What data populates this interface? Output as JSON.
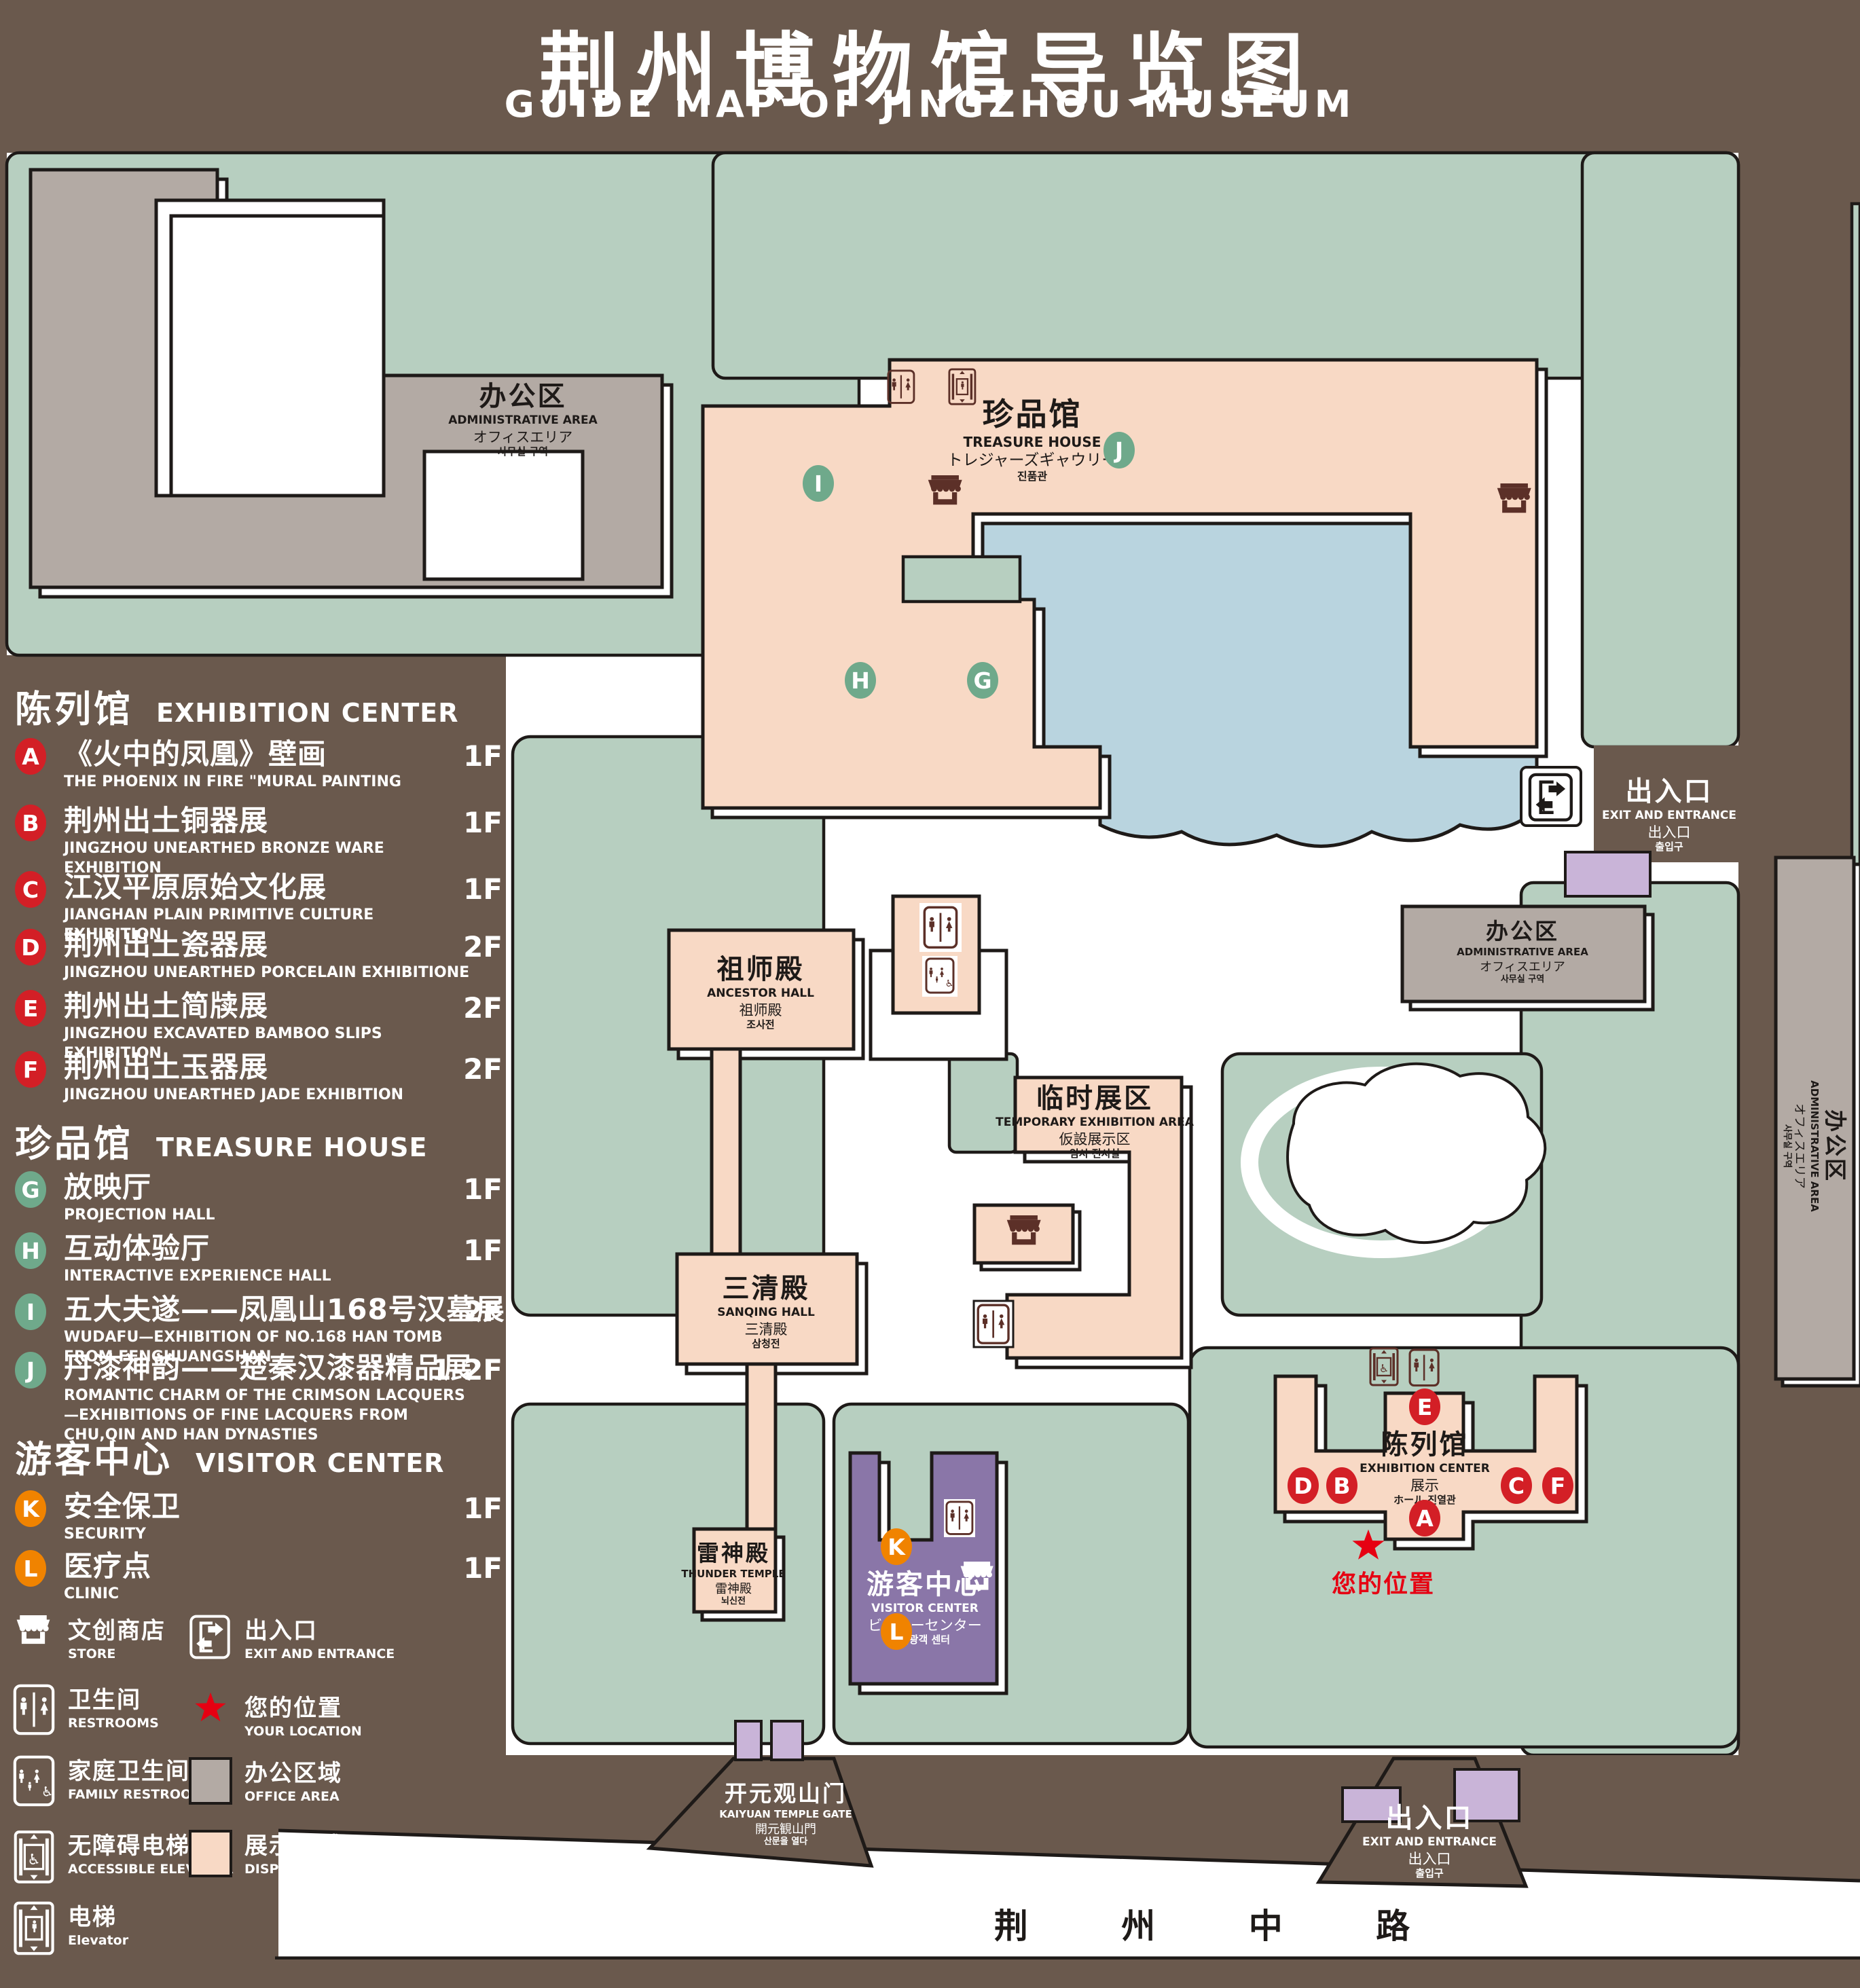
{
  "title": {
    "cn": "荆州博物馆导览图",
    "en": "GUIDE MAP OF JINGZHOU MUSEUM"
  },
  "colors": {
    "background": "#6a594d",
    "lawn": "#b7cfc0",
    "display_area": "#f8d9c5",
    "office_area": "#b3aaa4",
    "water": "#b9d4df",
    "visitor_center": "#8a76a8",
    "annex": "#c9b4d8",
    "badge_red": "#d31f26",
    "badge_green": "#6fa98b",
    "badge_orange": "#f08300",
    "location_red": "#e60012",
    "icon_maroon": "#5c3028",
    "outline": "#1e1a18"
  },
  "legend": {
    "sections": [
      {
        "cn": "陈列馆",
        "en": "EXHIBITION CENTER",
        "badge_color": "red",
        "items": [
          {
            "letter": "A",
            "cn": "《火中的凤凰》壁画",
            "en": "THE PHOENIX IN FIRE \"MURAL PAINTING",
            "floor": "1F"
          },
          {
            "letter": "B",
            "cn": "荆州出土铜器展",
            "en": "JINGZHOU UNEARTHED BRONZE WARE EXHIBITION",
            "floor": "1F"
          },
          {
            "letter": "C",
            "cn": "江汉平原原始文化展",
            "en": "JIANGHAN PLAIN PRIMITIVE CULTURE EXHIBITION",
            "floor": "1F"
          },
          {
            "letter": "D",
            "cn": "荆州出土瓷器展",
            "en": "JINGZHOU UNEARTHED PORCELAIN EXHIBITIONE",
            "floor": "2F"
          },
          {
            "letter": "E",
            "cn": "荆州出土简牍展",
            "en": "JINGZHOU EXCAVATED BAMBOO SLIPS EXHIBITION",
            "floor": "2F"
          },
          {
            "letter": "F",
            "cn": "荆州出土玉器展",
            "en": "JINGZHOU UNEARTHED JADE EXHIBITION",
            "floor": "2F"
          }
        ]
      },
      {
        "cn": "珍品馆",
        "en": "TREASURE HOUSE",
        "badge_color": "green",
        "items": [
          {
            "letter": "G",
            "cn": "放映厅",
            "en": "PROJECTION HALL",
            "floor": "1F"
          },
          {
            "letter": "H",
            "cn": "互动体验厅",
            "en": "INTERACTIVE EXPERIENCE HALL",
            "floor": "1F"
          },
          {
            "letter": "I",
            "cn": "五大夫遂——凤凰山168号汉墓展",
            "en": "WUDAFU—EXHIBITION OF NO.168 HAN TOMB FROM FENGHUANGSHAN",
            "floor": "2F"
          },
          {
            "letter": "J",
            "cn": "丹漆神韵——楚秦汉漆器精品展",
            "en": "ROMANTIC CHARM OF THE CRIMSON LACQUERS—EXHIBITIONS OF FINE LACQUERS FROM CHU,QIN AND HAN DYNASTIES",
            "floor": "1-2F"
          }
        ]
      },
      {
        "cn": "游客中心",
        "en": "VISITOR CENTER",
        "badge_color": "orange",
        "items": [
          {
            "letter": "K",
            "cn": "安全保卫",
            "en": "SECURITY",
            "floor": "1F"
          },
          {
            "letter": "L",
            "cn": "医疗点",
            "en": "CLINIC",
            "floor": "1F"
          }
        ]
      }
    ],
    "symbols": [
      {
        "icon": "store-icon",
        "cn": "文创商店",
        "en": "STORE"
      },
      {
        "icon": "exit-icon",
        "cn": "出入口",
        "en": "EXIT AND ENTRANCE"
      },
      {
        "icon": "restroom-icon",
        "cn": "卫生间",
        "en": "RESTROOMS"
      },
      {
        "icon": "location-star-icon",
        "cn": "您的位置",
        "en": "YOUR LOCATION"
      },
      {
        "icon": "family-restroom-icon",
        "cn": "家庭卫生间",
        "en": "FAMILY RESTROOMS"
      },
      {
        "icon": "office-area-swatch",
        "cn": "办公区域",
        "en": "OFFICE AREA"
      },
      {
        "icon": "accessible-elevator-icon",
        "cn": "无障碍电梯",
        "en": "ACCESSIBLE ELEVATOR"
      },
      {
        "icon": "display-area-swatch",
        "cn": "展示区域",
        "en": "DISPLAY AREA"
      },
      {
        "icon": "elevator-icon",
        "cn": "电梯",
        "en": "Elevator"
      }
    ]
  },
  "map": {
    "labels": [
      {
        "id": "admin-area-topleft",
        "lines": [
          "办公区",
          "ADMINISTRATIVE AREA",
          "オフィスエリア",
          "사무실 구역"
        ]
      },
      {
        "id": "treasure-house",
        "lines": [
          "珍品馆",
          "TREASURE HOUSE",
          "トレジャーズギャウリー",
          "진품관"
        ]
      },
      {
        "id": "ancestor-hall",
        "lines": [
          "祖师殿",
          "ANCESTOR HALL",
          "祖师殿",
          "조사전"
        ]
      },
      {
        "id": "temporary-exhibition",
        "lines": [
          "临时展区",
          "TEMPORARY EXHIBITION AREA",
          "仮設展示区",
          "임시 전시실"
        ]
      },
      {
        "id": "sanqing-hall",
        "lines": [
          "三清殿",
          "SANQING HALL",
          "三清殿",
          "삼청전"
        ]
      },
      {
        "id": "thunder-temple",
        "lines": [
          "雷神殿",
          "THUNDER TEMPLE",
          "雷神殿",
          "뇌신전"
        ]
      },
      {
        "id": "visitor-center",
        "lines": [
          "游客中心",
          "VISITOR CENTER",
          "ビジターセンター",
          "관광객 센터"
        ]
      },
      {
        "id": "exhibition-center",
        "lines": [
          "陈列馆",
          "EXHIBITION CENTER",
          "展示",
          "ホール 진열관"
        ]
      },
      {
        "id": "admin-area-right",
        "lines": [
          "办公区",
          "ADMINISTRATIVE AREA",
          "オフィスエリア",
          "사무실 구역"
        ]
      },
      {
        "id": "admin-area-strip",
        "lines": [
          "办公区",
          "ADMINISTRATIVE AREA",
          "オフィスエリア",
          "사무실 구역"
        ]
      },
      {
        "id": "exit-top-right",
        "lines": [
          "出入口",
          "EXIT AND ENTRANCE",
          "出入口",
          "출입구"
        ]
      },
      {
        "id": "exit-bottom-right",
        "lines": [
          "出入口",
          "EXIT AND ENTRANCE",
          "出入口",
          "출입구"
        ]
      },
      {
        "id": "kaiyuan-gate",
        "lines": [
          "开元观山门",
          "KAIYUAN TEMPLE GATE",
          "開元観山門",
          "산문을 열다"
        ]
      }
    ],
    "badges": [
      {
        "letter": "I",
        "color": "green"
      },
      {
        "letter": "J",
        "color": "green"
      },
      {
        "letter": "H",
        "color": "green"
      },
      {
        "letter": "G",
        "color": "green"
      },
      {
        "letter": "E",
        "color": "red"
      },
      {
        "letter": "D",
        "color": "red"
      },
      {
        "letter": "B",
        "color": "red"
      },
      {
        "letter": "C",
        "color": "red"
      },
      {
        "letter": "F",
        "color": "red"
      },
      {
        "letter": "A",
        "color": "red"
      },
      {
        "letter": "K",
        "color": "orange"
      },
      {
        "letter": "L",
        "color": "orange"
      }
    ],
    "your_location": "您的位置",
    "road": "荆 州 中 路"
  }
}
